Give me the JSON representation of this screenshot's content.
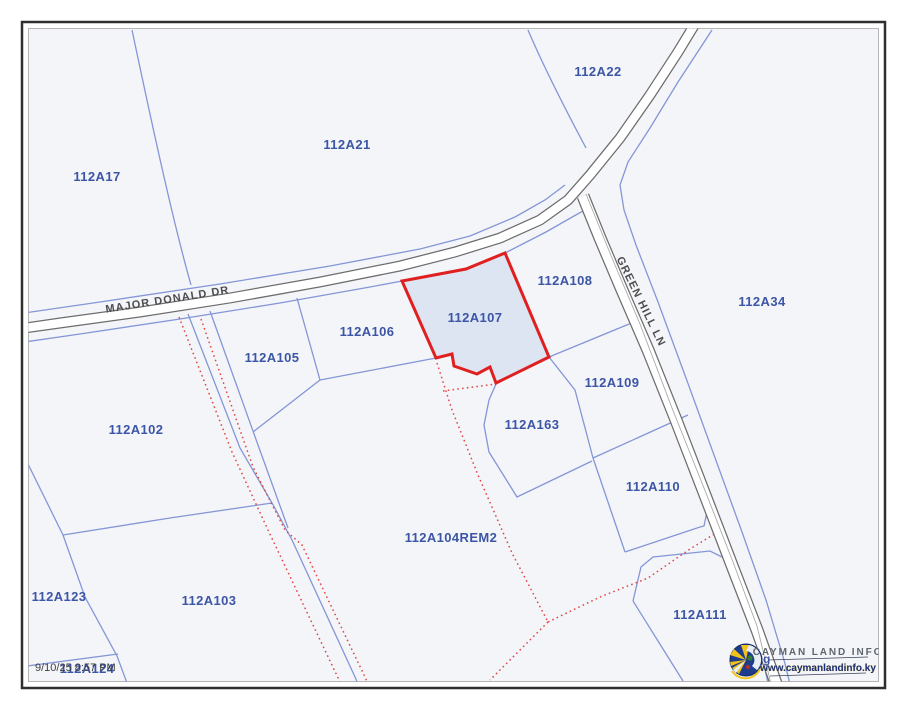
{
  "map": {
    "parcels": [
      {
        "id": "112A17"
      },
      {
        "id": "112A21"
      },
      {
        "id": "112A22"
      },
      {
        "id": "112A34"
      },
      {
        "id": "112A106"
      },
      {
        "id": "112A105"
      },
      {
        "id": "112A107"
      },
      {
        "id": "112A108"
      },
      {
        "id": "112A109"
      },
      {
        "id": "112A163"
      },
      {
        "id": "112A110"
      },
      {
        "id": "112A104REM2"
      },
      {
        "id": "112A102"
      },
      {
        "id": "112A103"
      },
      {
        "id": "112A123"
      },
      {
        "id": "112A124"
      },
      {
        "id": "112A111"
      }
    ],
    "selected_parcel": "112A107",
    "roads": [
      {
        "name": "MAJOR DONALD DR"
      },
      {
        "name": "GREEN HILL LN"
      }
    ],
    "obscured_fragments": {
      "left": "1",
      "right": "g"
    },
    "colors": {
      "selected_fill": "#dde5f2",
      "selected_stroke": "#e02020",
      "parcel_line": "#8496d6",
      "pending_line_dotted": "#e04848",
      "road_casing": "#6d6d6d",
      "map_background": "#f4f5f9",
      "label_color": "#3c55a5"
    }
  },
  "footer": {
    "timestamp": "9/10/25 8:57 PM"
  },
  "logo": {
    "title": "CAYMAN LAND INFO",
    "url": "www.caymanlandinfo.ky"
  }
}
